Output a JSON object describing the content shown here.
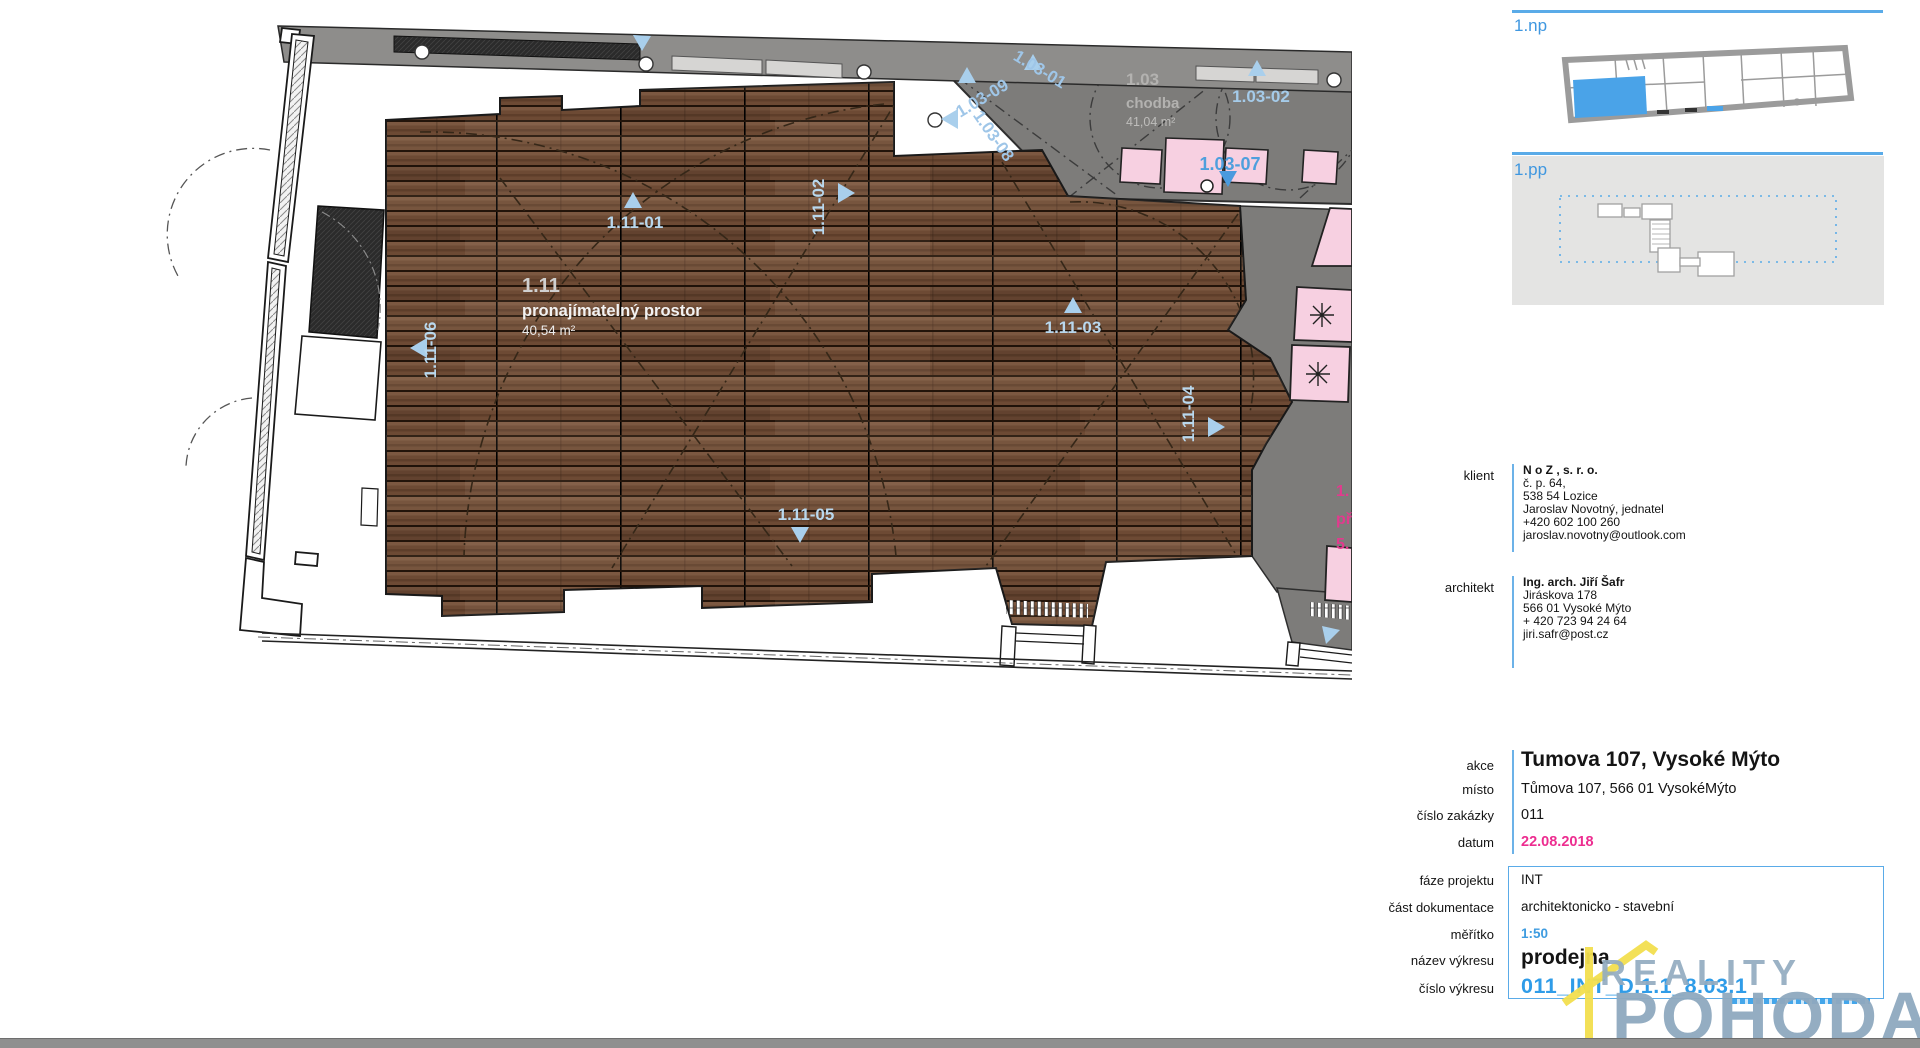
{
  "plan": {
    "main_room": {
      "id": "1.11",
      "name": "pronajímatelný prostor",
      "area": "40,54 m²"
    },
    "corridor": {
      "id": "1.03",
      "name": "chodba",
      "area": "41,04 m²"
    },
    "wood_labels": [
      "1.11-01",
      "1.11-02",
      "1.11-03",
      "1.11-04",
      "1.11-05",
      "1.11-06"
    ],
    "corridor_labels": [
      "1.03-09",
      "1.03-01",
      "1.03-08",
      "1.03-02",
      "1.03-07"
    ],
    "clipped": [
      "1.",
      "př",
      "5."
    ]
  },
  "thumbnails": {
    "np": "1.np",
    "pp": "1.pp"
  },
  "contacts": {
    "klient": {
      "label": "klient",
      "name": "N o Z , s. r. o.",
      "lines": [
        "č. p. 64,",
        "538 54 Lozice",
        "Jaroslav Novotný, jednatel",
        "+420 602 100 260",
        "jaroslav.novotny@outlook.com"
      ]
    },
    "architekt": {
      "label": "architekt",
      "name": "Ing. arch. Jiří Šafr",
      "lines": [
        "Jiráskova 178",
        "566 01 Vysoké Mýto",
        "+ 420 723 94 24 64",
        "jiri.safr@post.cz"
      ]
    }
  },
  "project": {
    "rows": [
      {
        "label": "akce",
        "value": "Tumova 107, Vysoké Mýto"
      },
      {
        "label": "místo",
        "value": "Tůmova 107, 566 01 VysokéMýto"
      },
      {
        "label": "číslo zakázky",
        "value": "011"
      },
      {
        "label": "datum",
        "value": "22.08.2018"
      }
    ]
  },
  "drawing": {
    "rows": [
      {
        "label": "fáze projektu",
        "value": "INT"
      },
      {
        "label": "část dokumentace",
        "value": "architektonicko - stavební"
      },
      {
        "label": "měřítko",
        "value": "1:50"
      },
      {
        "label": "název výkresu",
        "value": "prodejna"
      },
      {
        "label": "číslo výkresu",
        "value": "011_INT_D.1.1_8.03.1"
      }
    ]
  },
  "logo": {
    "line1": "REALITY",
    "line2": "POHODA"
  },
  "colors": {
    "accent_blue": "#3f9ce0",
    "light_blue_label": "#b9d8ee",
    "corridor_blue": "#4f9fdd",
    "magenta": "#ed2d90",
    "corridor_gray": "#7d7c7a",
    "pink": "#f7d0e1",
    "wood_base": "#6d4a34",
    "logo_gray": "#8fa9bf",
    "logo_yellow": "#f2de4e"
  }
}
